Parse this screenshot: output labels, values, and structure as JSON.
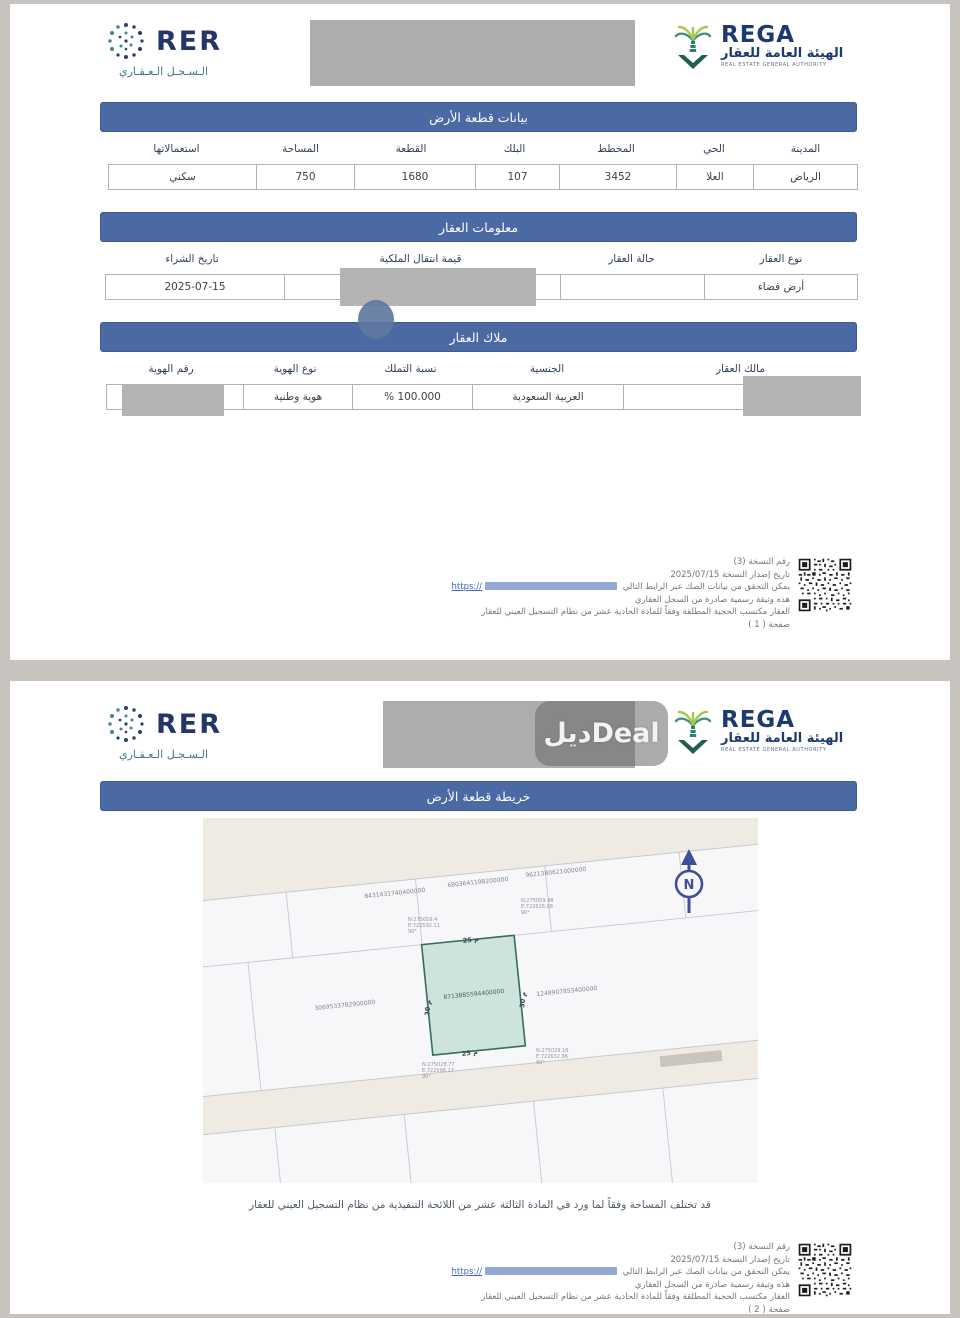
{
  "brand": {
    "rer": {
      "name": "RER",
      "arabic": "الـسـجـل الـعـقـاري"
    },
    "rega": {
      "name": "REGA",
      "arabic": "الهيئة العامة للعقار",
      "tagline": "REAL ESTATE GENERAL AUTHORITY"
    }
  },
  "watermark": {
    "text": "ديلDeal"
  },
  "page1": {
    "land_section": {
      "title": "بيانات قطعة الأرض",
      "columns": [
        {
          "label": "المدينة",
          "value": "الرياض"
        },
        {
          "label": "الحي",
          "value": "العلا"
        },
        {
          "label": "المخطط",
          "value": "3452"
        },
        {
          "label": "البلك",
          "value": "107"
        },
        {
          "label": "القطعة",
          "value": "1680"
        },
        {
          "label": "المساحة",
          "value": "750"
        },
        {
          "label": "استعمالاتها",
          "value": "سكني"
        }
      ]
    },
    "property_section": {
      "title": "معلومات العقار",
      "columns": [
        {
          "label": "نوع العقار",
          "value": "أرض فضاء"
        },
        {
          "label": "حالة العقار",
          "value": ""
        },
        {
          "label": "قيمة انتقال الملكية",
          "value": ""
        },
        {
          "label": "تاريخ الشراء",
          "value": "2025-07-15"
        }
      ]
    },
    "owners_section": {
      "title": "ملاك العقار",
      "columns": [
        {
          "label": "مالك العقار",
          "value": "ن محمد كعبي"
        },
        {
          "label": "الجنسية",
          "value": "العربية السعودية"
        },
        {
          "label": "نسبة التملك",
          "value": "% 100.000"
        },
        {
          "label": "نوع الهوية",
          "value": "هوية وطنية"
        },
        {
          "label": "رقم الهوية",
          "value": ""
        }
      ]
    }
  },
  "page2": {
    "map_title": "خريطة قطعة الأرض",
    "map": {
      "north": "N",
      "plots": [
        {
          "number": "8431431740400000"
        },
        {
          "number": "6803641198200000"
        },
        {
          "number": "9621380621000000"
        },
        {
          "number": "1248907853400000"
        },
        {
          "number": "3069533782900000"
        }
      ],
      "selected_plot": {
        "number": "8713885594400000",
        "top_length": "25 م",
        "bottom_length": "25 م",
        "left_length": "30 م",
        "right_length": "30 م",
        "corners": {
          "tl": [
            "N:275059.4",
            "E:722592.11",
            "90°"
          ],
          "tr": [
            "N:275059.48",
            "E:722626.08",
            "90°"
          ],
          "br": [
            "N:275029.16",
            "E:722632.96",
            "90°"
          ],
          "bl": [
            "N:275028.77",
            "E:722598.17",
            "90°"
          ]
        }
      }
    },
    "disclaimer": "قد تختلف المساحة وفقاً لما ورد في المادة الثالثة عشر من اللائحة التنفيذية من نظام التسجيل العيني للعقار"
  },
  "footer": {
    "copy_number": "رقم النسخة (3)",
    "issue_date": "تاريخ إصدار النسخة 2025/07/15",
    "verify_text": "يمكن التحقق من بيانات الصك عبر الرابط التالي",
    "link_text": "https://",
    "official_text": "هذه وثيقة رسمية صادرة من السجل العقاري",
    "legal_text": "العقار مكتسب الحجية المطلقة وفقاً للمادة الحادية عشر من نظام التسجيل العيني للعقار",
    "page_labels": {
      "p1": "صفحة ( 1 )",
      "p2": "صفحة ( 2 )"
    }
  }
}
